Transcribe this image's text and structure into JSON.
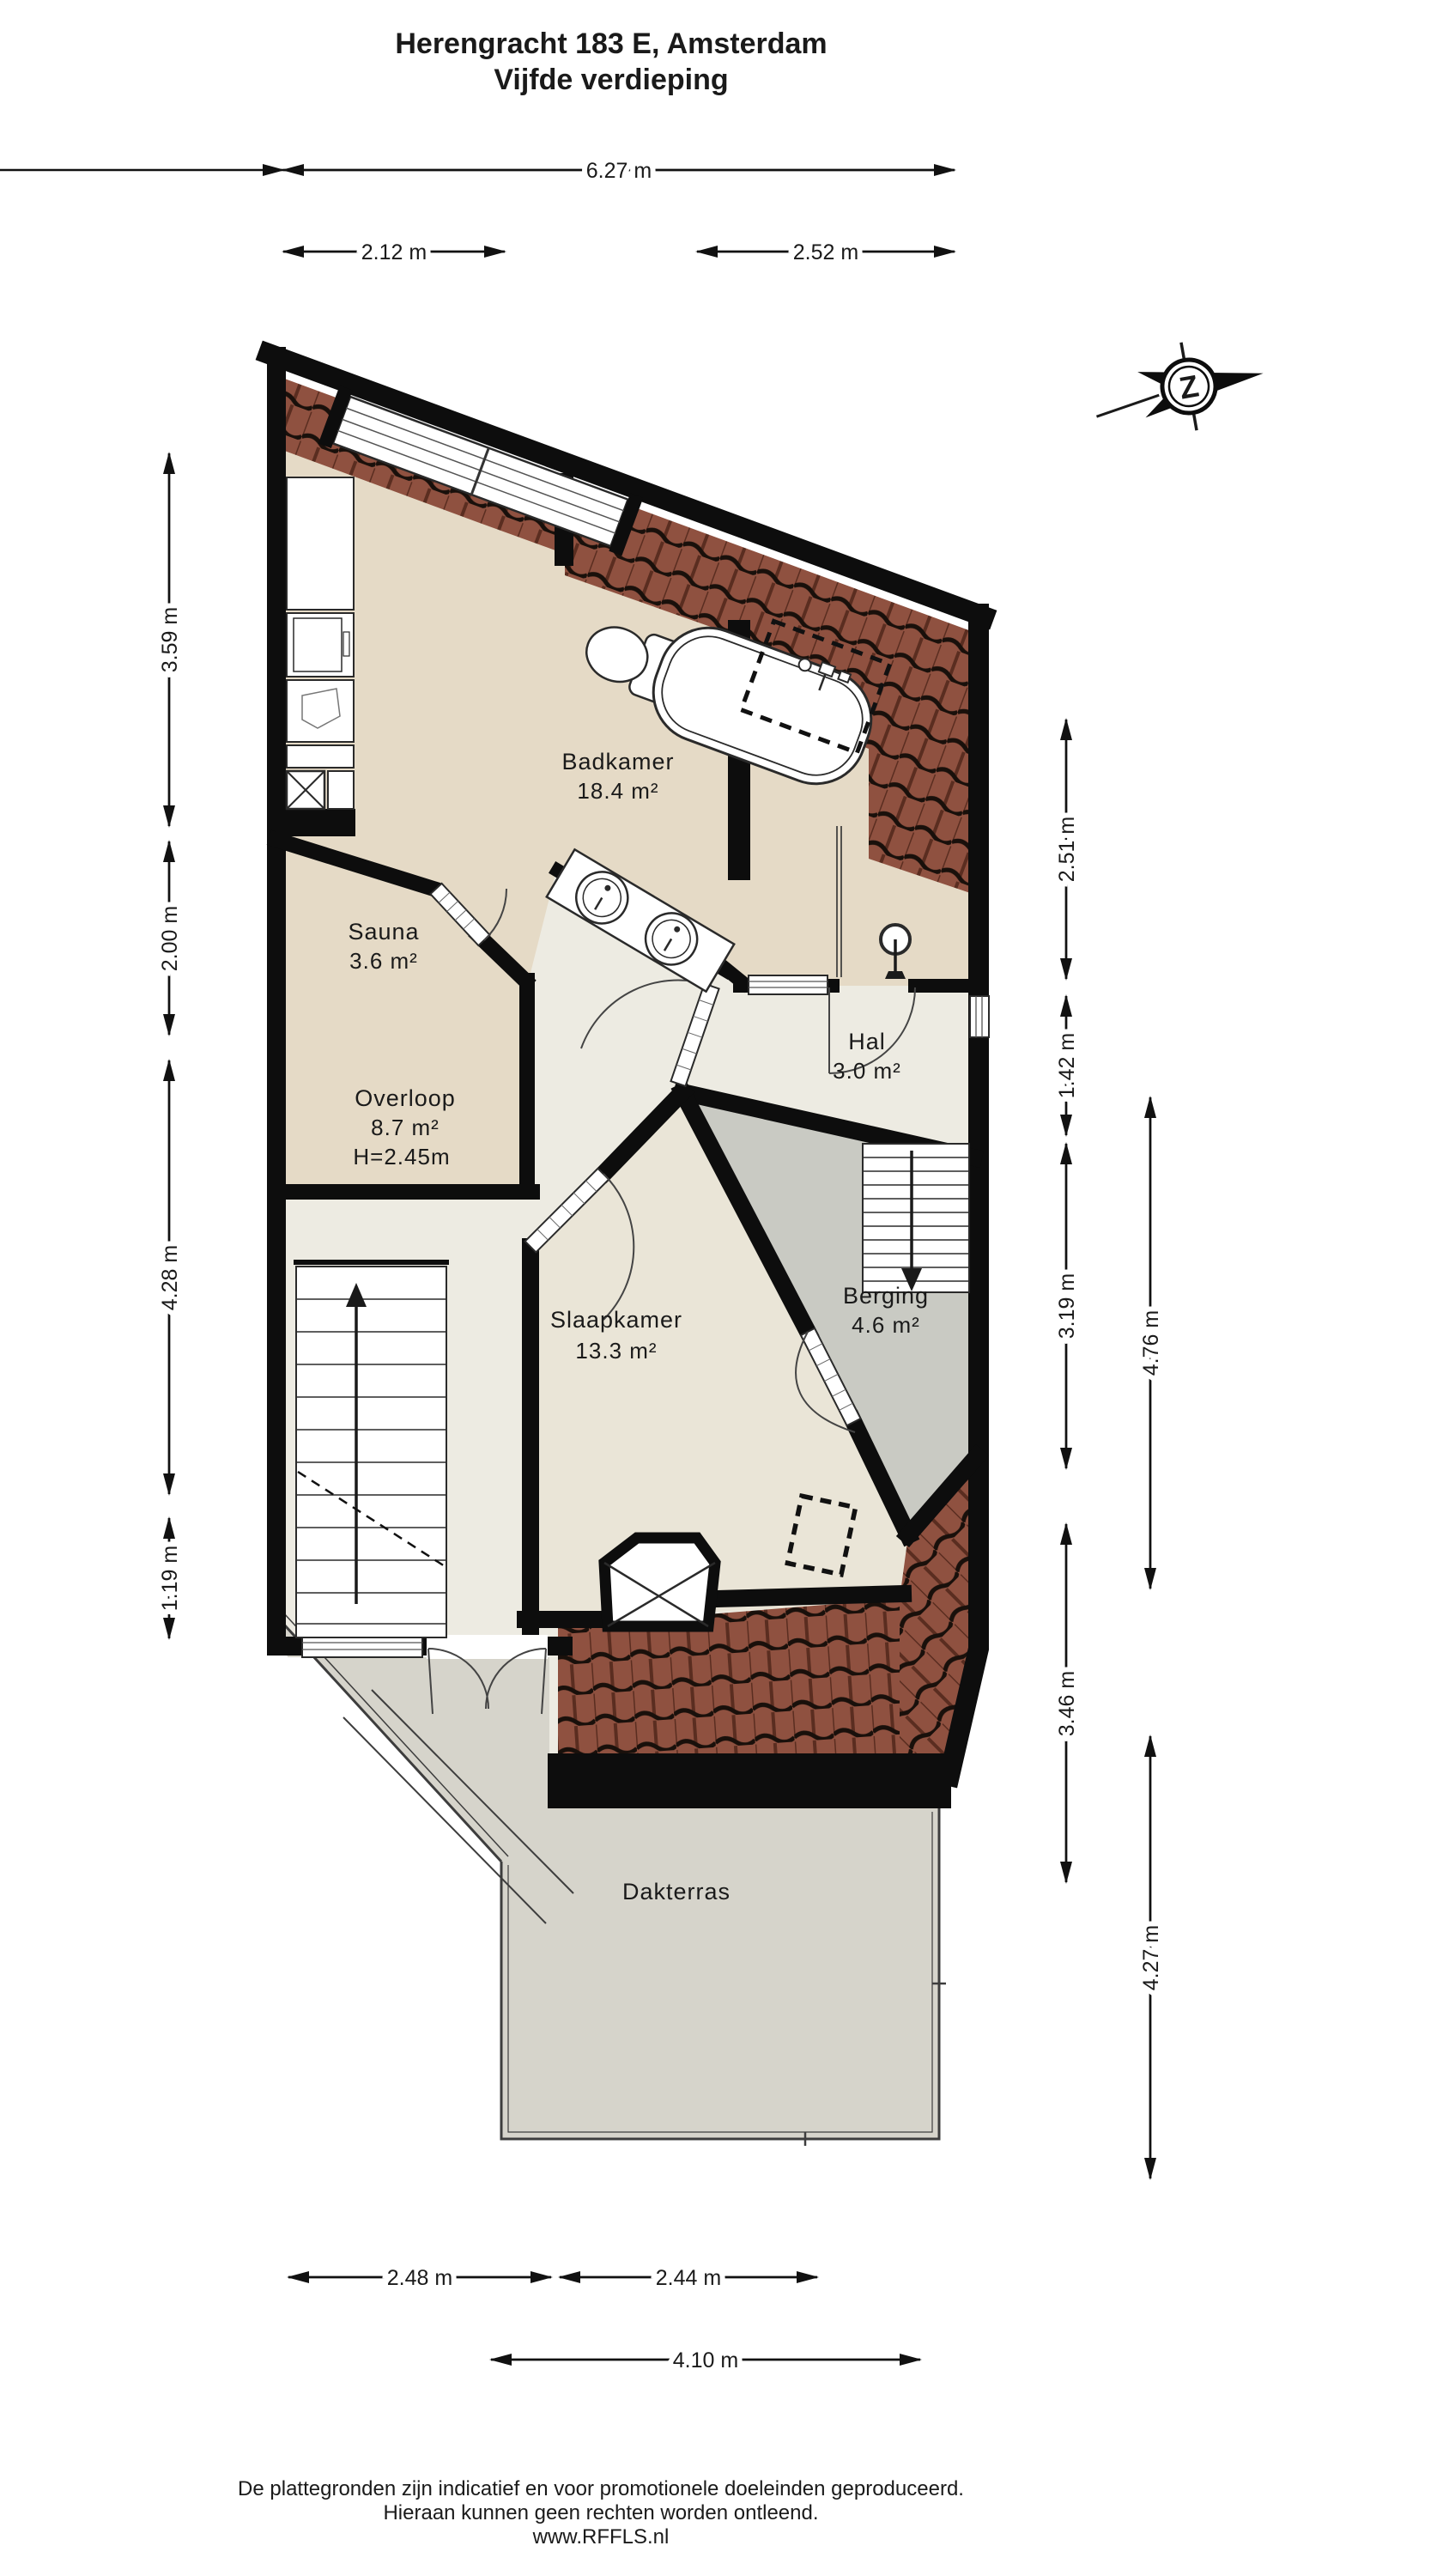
{
  "title": {
    "line1": "Herengracht 183 E, Amsterdam",
    "line2": "Vijfde verdieping"
  },
  "compass": {
    "letter": "Z"
  },
  "rooms": {
    "badkamer": {
      "name": "Badkamer",
      "area": "18.4 m²"
    },
    "sauna": {
      "name": "Sauna",
      "area": "3.6 m²"
    },
    "hal": {
      "name": "Hal",
      "area": "3.0 m²"
    },
    "overloop": {
      "name": "Overloop",
      "area": "8.7 m²",
      "height": "H=2.45m"
    },
    "slaapkamer": {
      "name": "Slaapkamer",
      "area": "13.3 m²"
    },
    "berging": {
      "name": "Berging",
      "area": "4.6 m²"
    },
    "dakterras": {
      "name": "Dakterras"
    }
  },
  "dims": {
    "top": [
      "6.27 m",
      "2.12 m",
      "2.52 m"
    ],
    "bottom": [
      "2.48 m",
      "2.44 m",
      "4.10 m"
    ],
    "left": [
      "3.59 m",
      "2.00 m",
      "4.28 m",
      "1.19 m"
    ],
    "right": [
      "2.51 m",
      "1.42 m",
      "3.19 m",
      "3.46 m",
      "4.76 m",
      "4.27 m"
    ]
  },
  "footer": {
    "line1": "De plattegronden zijn indicatief en voor promotionele doeleinden geproduceerd.",
    "line2": "Hieraan kunnen geen rechten worden ontleend.",
    "line3": "www.RFFLS.nl"
  },
  "colors": {
    "wall": "#0d0d0d",
    "floor_bath": "#e5dac6",
    "floor_hall": "#edebe2",
    "floor_bed": "#eae5d7",
    "berging": "#c9cac3",
    "terrace": "#d6d4cb",
    "roof": "#8f5140",
    "roof_dark": "#19100b",
    "roof_rib": "#5a2d20"
  }
}
